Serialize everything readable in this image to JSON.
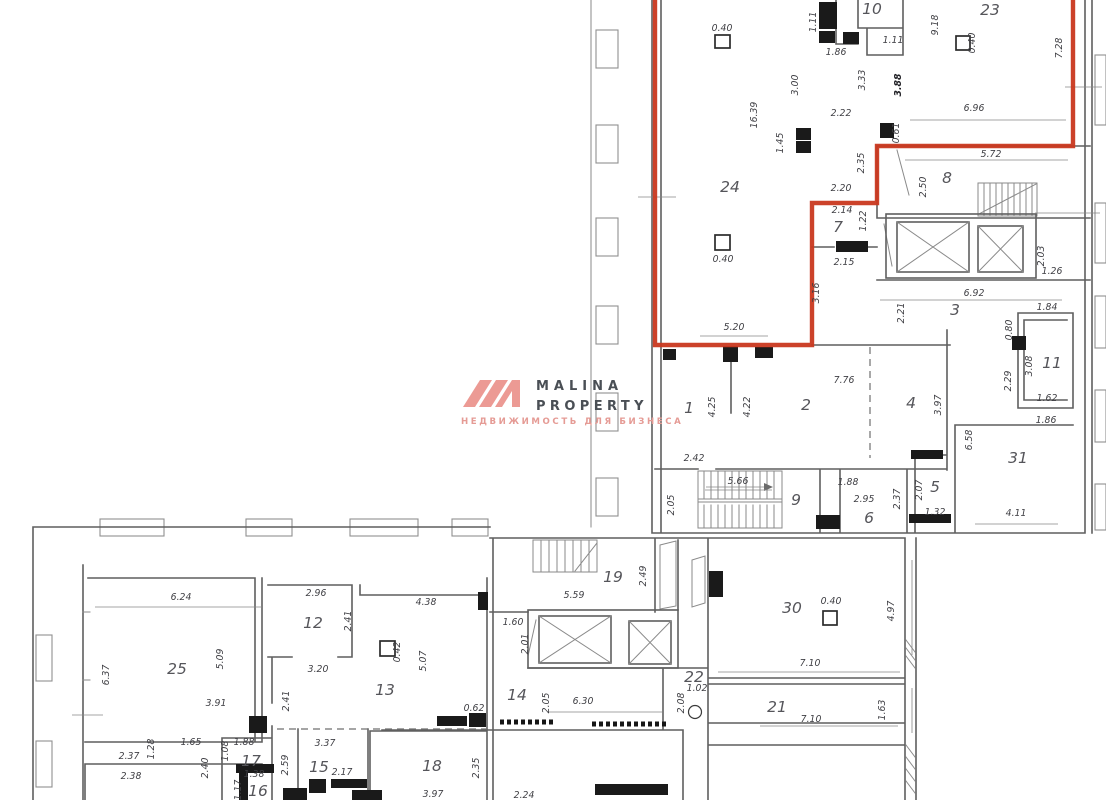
{
  "brand": {
    "line1": "MALINA",
    "line2": "PROPERTY",
    "tagline": "НЕДВИЖИМОСТЬ ДЛЯ БИЗНЕСА"
  },
  "colors": {
    "highlight_outline": "#c9381f",
    "brand_accent": "#ec9a94",
    "brand_text": "#4a4f55",
    "wall_line": "#5f5f5f",
    "dimension_text": "#3f3f44"
  },
  "plan": {
    "rooms": [
      {
        "t": "10",
        "x": 872,
        "y": 14
      },
      {
        "t": "23",
        "x": 990,
        "y": 15
      },
      {
        "t": "24",
        "x": 730,
        "y": 192
      },
      {
        "t": "8",
        "x": 947,
        "y": 183
      },
      {
        "t": "7",
        "x": 838,
        "y": 232
      },
      {
        "t": "3",
        "x": 955,
        "y": 315
      },
      {
        "t": "11",
        "x": 1052,
        "y": 368
      },
      {
        "t": "1",
        "x": 689,
        "y": 413
      },
      {
        "t": "2",
        "x": 806,
        "y": 410
      },
      {
        "t": "4",
        "x": 911,
        "y": 408
      },
      {
        "t": "31",
        "x": 1018,
        "y": 463
      },
      {
        "t": "9",
        "x": 796,
        "y": 505
      },
      {
        "t": "6",
        "x": 869,
        "y": 523
      },
      {
        "t": "5",
        "x": 935,
        "y": 492
      },
      {
        "t": "19",
        "x": 613,
        "y": 582
      },
      {
        "t": "30",
        "x": 792,
        "y": 613
      },
      {
        "t": "12",
        "x": 313,
        "y": 628
      },
      {
        "t": "13",
        "x": 385,
        "y": 695
      },
      {
        "t": "14",
        "x": 517,
        "y": 700
      },
      {
        "t": "22",
        "x": 694,
        "y": 682
      },
      {
        "t": "21",
        "x": 777,
        "y": 712
      },
      {
        "t": "25",
        "x": 177,
        "y": 674
      },
      {
        "t": "15",
        "x": 319,
        "y": 772
      },
      {
        "t": "17",
        "x": 251,
        "y": 766
      },
      {
        "t": "16",
        "x": 258,
        "y": 796
      },
      {
        "t": "18",
        "x": 432,
        "y": 771
      }
    ],
    "dims": [
      {
        "t": "0.40",
        "x": 722,
        "y": 31
      },
      {
        "t": "1.11",
        "x": 816,
        "y": 22,
        "r": -90
      },
      {
        "t": "1.86",
        "x": 836,
        "y": 55
      },
      {
        "t": "1.11",
        "x": 893,
        "y": 43
      },
      {
        "t": "9.18",
        "x": 938,
        "y": 25,
        "r": -90
      },
      {
        "t": "0.40",
        "x": 975,
        "y": 43,
        "r": -90
      },
      {
        "t": "7.28",
        "x": 1062,
        "y": 48,
        "r": -90
      },
      {
        "t": "3.00",
        "x": 798,
        "y": 85,
        "r": -90
      },
      {
        "t": "16.39",
        "x": 757,
        "y": 115,
        "r": -90
      },
      {
        "t": "3.33",
        "x": 865,
        "y": 80,
        "r": -90
      },
      {
        "t": "3.88",
        "x": 901,
        "y": 85,
        "r": -90,
        "b": true
      },
      {
        "t": "2.22",
        "x": 841,
        "y": 116
      },
      {
        "t": "6.96",
        "x": 974,
        "y": 111
      },
      {
        "t": "1.45",
        "x": 783,
        "y": 143,
        "r": -90
      },
      {
        "t": "0.61",
        "x": 899,
        "y": 133,
        "r": -90
      },
      {
        "t": "5.72",
        "x": 991,
        "y": 157
      },
      {
        "t": "2.35",
        "x": 864,
        "y": 163,
        "r": -90
      },
      {
        "t": "2.50",
        "x": 926,
        "y": 187,
        "r": -90
      },
      {
        "t": "2.20",
        "x": 841,
        "y": 191
      },
      {
        "t": "2.14",
        "x": 842,
        "y": 213
      },
      {
        "t": "1.22",
        "x": 866,
        "y": 221,
        "r": -90
      },
      {
        "t": "2.15",
        "x": 844,
        "y": 265
      },
      {
        "t": "3.16",
        "x": 819,
        "y": 293,
        "r": -90
      },
      {
        "t": "2.03",
        "x": 1044,
        "y": 256,
        "r": -90
      },
      {
        "t": "1.26",
        "x": 1052,
        "y": 274
      },
      {
        "t": "6.92",
        "x": 974,
        "y": 296
      },
      {
        "t": "2.21",
        "x": 904,
        "y": 313,
        "r": -90
      },
      {
        "t": "1.84",
        "x": 1047,
        "y": 310
      },
      {
        "t": "0.80",
        "x": 1012,
        "y": 330,
        "r": -90
      },
      {
        "t": "0.40",
        "x": 723,
        "y": 262
      },
      {
        "t": "5.20",
        "x": 734,
        "y": 330
      },
      {
        "t": "3.08",
        "x": 1032,
        "y": 366,
        "r": -90
      },
      {
        "t": "2.29",
        "x": 1011,
        "y": 381,
        "r": -90
      },
      {
        "t": "1.62",
        "x": 1047,
        "y": 401
      },
      {
        "t": "1.86",
        "x": 1046,
        "y": 423
      },
      {
        "t": "7.76",
        "x": 844,
        "y": 383
      },
      {
        "t": "4.25",
        "x": 715,
        "y": 407,
        "r": -90
      },
      {
        "t": "4.22",
        "x": 750,
        "y": 407,
        "r": -90
      },
      {
        "t": "3.97",
        "x": 941,
        "y": 405,
        "r": -90
      },
      {
        "t": "6.58",
        "x": 972,
        "y": 440,
        "r": -90
      },
      {
        "t": "2.42",
        "x": 694,
        "y": 461
      },
      {
        "t": "5.66",
        "x": 738,
        "y": 484
      },
      {
        "t": "2.05",
        "x": 674,
        "y": 505,
        "r": -90
      },
      {
        "t": "1.88",
        "x": 848,
        "y": 485
      },
      {
        "t": "2.95",
        "x": 864,
        "y": 502
      },
      {
        "t": "2.37",
        "x": 900,
        "y": 499,
        "r": -90
      },
      {
        "t": "2.07",
        "x": 922,
        "y": 490,
        "r": -90
      },
      {
        "t": "1.32",
        "x": 935,
        "y": 515
      },
      {
        "t": "4.11",
        "x": 1016,
        "y": 516
      },
      {
        "t": "6.24",
        "x": 181,
        "y": 600
      },
      {
        "t": "2.96",
        "x": 316,
        "y": 596
      },
      {
        "t": "2.41",
        "x": 351,
        "y": 621,
        "r": -90
      },
      {
        "t": "4.38",
        "x": 426,
        "y": 605
      },
      {
        "t": "5.09",
        "x": 223,
        "y": 659,
        "r": -90
      },
      {
        "t": "6.37",
        "x": 109,
        "y": 675,
        "r": -90
      },
      {
        "t": "3.20",
        "x": 318,
        "y": 672
      },
      {
        "t": "0.42",
        "x": 400,
        "y": 652,
        "r": -90
      },
      {
        "t": "5.07",
        "x": 426,
        "y": 661,
        "r": -90
      },
      {
        "t": "3.91",
        "x": 216,
        "y": 706
      },
      {
        "t": "2.41",
        "x": 289,
        "y": 701,
        "r": -90
      },
      {
        "t": "1.60",
        "x": 513,
        "y": 625
      },
      {
        "t": "2.01",
        "x": 528,
        "y": 644,
        "r": -90
      },
      {
        "t": "2.49",
        "x": 646,
        "y": 576,
        "r": -90
      },
      {
        "t": "5.59",
        "x": 574,
        "y": 598
      },
      {
        "t": "2.05",
        "x": 549,
        "y": 703,
        "r": -90
      },
      {
        "t": "6.30",
        "x": 583,
        "y": 704
      },
      {
        "t": "0.62",
        "x": 474,
        "y": 711
      },
      {
        "t": "1.02",
        "x": 697,
        "y": 691
      },
      {
        "t": "2.08",
        "x": 684,
        "y": 703,
        "r": -90
      },
      {
        "t": "0.40",
        "x": 831,
        "y": 604
      },
      {
        "t": "7.10",
        "x": 810,
        "y": 666
      },
      {
        "t": "4.97",
        "x": 894,
        "y": 611,
        "r": -90
      },
      {
        "t": "7.10",
        "x": 811,
        "y": 722
      },
      {
        "t": "1.63",
        "x": 885,
        "y": 710,
        "r": -90
      },
      {
        "t": "2.37",
        "x": 129,
        "y": 759
      },
      {
        "t": "2.38",
        "x": 131,
        "y": 779
      },
      {
        "t": "1.28",
        "x": 154,
        "y": 749,
        "r": -90
      },
      {
        "t": "1.65",
        "x": 191,
        "y": 745
      },
      {
        "t": "2.40",
        "x": 208,
        "y": 768,
        "r": -90
      },
      {
        "t": "1.08",
        "x": 228,
        "y": 751,
        "r": -90
      },
      {
        "t": "1.88",
        "x": 244,
        "y": 745
      },
      {
        "t": "1.38",
        "x": 254,
        "y": 777
      },
      {
        "t": "1.17",
        "x": 241,
        "y": 790,
        "r": -90
      },
      {
        "t": "2.59",
        "x": 288,
        "y": 765,
        "r": -90
      },
      {
        "t": "3.37",
        "x": 325,
        "y": 746
      },
      {
        "t": "2.17",
        "x": 342,
        "y": 775
      },
      {
        "t": "3.97",
        "x": 433,
        "y": 797
      },
      {
        "t": "2.35",
        "x": 479,
        "y": 768,
        "r": -90
      },
      {
        "t": "2.24",
        "x": 524,
        "y": 798
      }
    ]
  }
}
